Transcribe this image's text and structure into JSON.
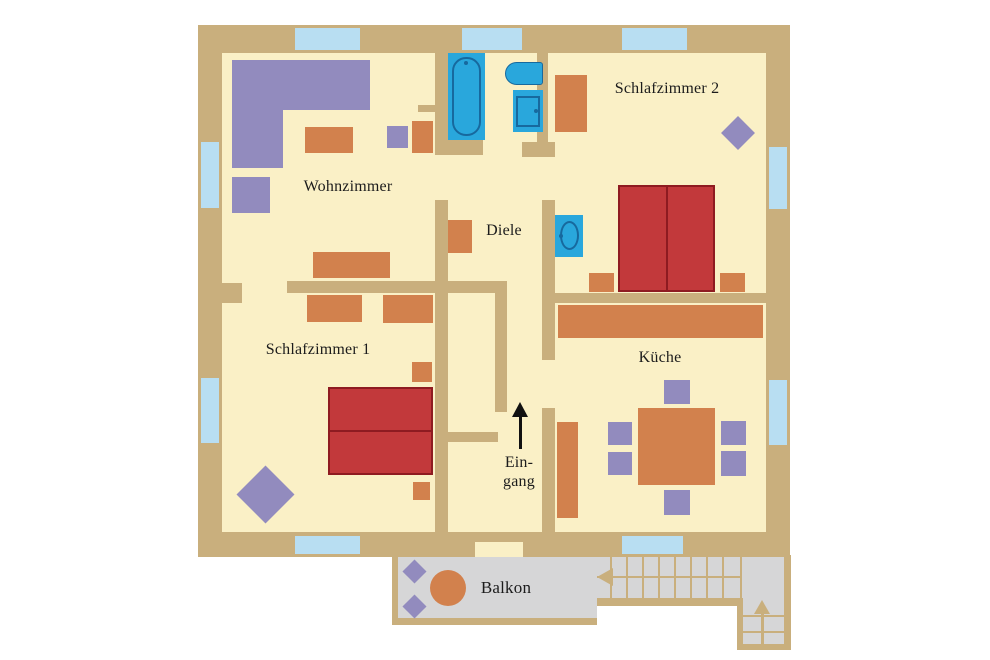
{
  "colors": {
    "wall": "#C9AF7D",
    "floor": "#FAF0C6",
    "window": "#B8DEF2",
    "furnOrange": "#D2814D",
    "furnPurple": "#928BBE",
    "bedRed": "#C2393B",
    "bedStroke": "#8E1B21",
    "fixtureBlue": "#29A7DC",
    "fixtureStroke": "#17699E",
    "balconyGray": "#D6D6D7",
    "text": "#1C1C1C",
    "arrow": "#111111"
  },
  "rooms": {
    "wohnzimmer": {
      "label": "Wohnzimmer"
    },
    "schlafzimmer1": {
      "label": "Schlafzimmer 1"
    },
    "schlafzimmer2": {
      "label": "Schlafzimmer 2"
    },
    "diele": {
      "label": "Diele"
    },
    "kueche": {
      "label": "Küche"
    },
    "eingang": {
      "line1": "Ein-",
      "line2": "gang"
    },
    "balkon": {
      "label": "Balkon"
    }
  }
}
